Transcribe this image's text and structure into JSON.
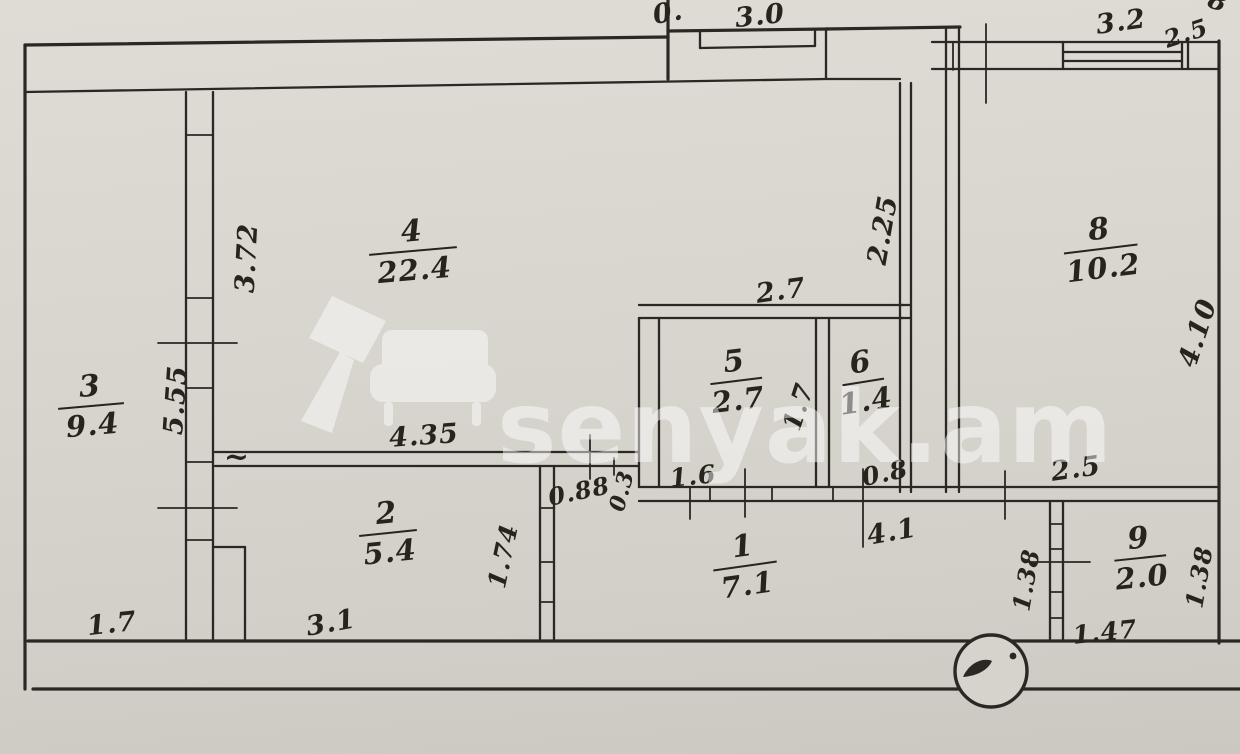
{
  "document": {
    "kind": "scanned hand-drawn apartment floor plan",
    "paper_color": "#d8d5ce",
    "ink_color": "#2b2722"
  },
  "watermark": {
    "text": "senyak.am",
    "color": "#ffffff"
  },
  "rooms": [
    {
      "number": "1",
      "area": "7.1",
      "cx": 745,
      "cy": 566,
      "bar": 64,
      "rot": -8
    },
    {
      "number": "2",
      "area": "5.4",
      "cx": 388,
      "cy": 533,
      "bar": 58,
      "rot": -6
    },
    {
      "number": "3",
      "area": "9.4",
      "cx": 91,
      "cy": 406,
      "bar": 66,
      "rot": -5
    },
    {
      "number": "4",
      "area": "22.4",
      "cx": 413,
      "cy": 251,
      "bar": 88,
      "rot": -5
    },
    {
      "number": "5",
      "area": "2.7",
      "cx": 736,
      "cy": 381,
      "bar": 52,
      "rot": -7
    },
    {
      "number": "6",
      "area": "1.4",
      "cx": 863,
      "cy": 382,
      "bar": 42,
      "rot": -9
    },
    {
      "number": "8",
      "area": "10.2",
      "cx": 1101,
      "cy": 249,
      "bar": 74,
      "rot": -7
    },
    {
      "number": "9",
      "area": "2.0",
      "cx": 1140,
      "cy": 558,
      "bar": 52,
      "rot": -6
    }
  ],
  "dimensions": [
    {
      "text": "0.",
      "x": 668,
      "y": 13,
      "rot": -10
    },
    {
      "text": "3.0",
      "x": 760,
      "y": 16,
      "rot": -6
    },
    {
      "text": "3.2",
      "x": 1121,
      "y": 22,
      "rot": -8
    },
    {
      "text": "2.5",
      "x": 1186,
      "y": 33,
      "rot": -18,
      "size": 24
    },
    {
      "text": "8",
      "x": 1218,
      "y": 2,
      "rot": 20,
      "size": 26
    },
    {
      "text": "3.72",
      "x": 247,
      "y": 258,
      "rot": -87
    },
    {
      "text": "5.55",
      "x": 176,
      "y": 400,
      "rot": -86
    },
    {
      "text": "2.25",
      "x": 883,
      "y": 230,
      "rot": -80
    },
    {
      "text": "2.7",
      "x": 781,
      "y": 291,
      "rot": -8
    },
    {
      "text": "4.10",
      "x": 1198,
      "y": 333,
      "rot": -72
    },
    {
      "text": "4.35",
      "x": 424,
      "y": 436,
      "rot": -4
    },
    {
      "text": "~",
      "x": 237,
      "y": 457,
      "rot": 0,
      "size": 30
    },
    {
      "text": "0.88",
      "x": 579,
      "y": 491,
      "rot": -12,
      "size": 24
    },
    {
      "text": "0.3",
      "x": 622,
      "y": 491,
      "rot": -75,
      "size": 22
    },
    {
      "text": "1.6",
      "x": 693,
      "y": 476,
      "rot": -6,
      "size": 25
    },
    {
      "text": "0.8",
      "x": 885,
      "y": 473,
      "rot": -12,
      "size": 25
    },
    {
      "text": "1.7",
      "x": 799,
      "y": 407,
      "rot": -72,
      "size": 26
    },
    {
      "text": "2.5",
      "x": 1076,
      "y": 469,
      "rot": -8
    },
    {
      "text": "4.1",
      "x": 892,
      "y": 532,
      "rot": -10
    },
    {
      "text": "1.74",
      "x": 503,
      "y": 556,
      "rot": -78,
      "size": 25
    },
    {
      "text": "1.38",
      "x": 1026,
      "y": 580,
      "rot": -80,
      "size": 24
    },
    {
      "text": "1.38",
      "x": 1199,
      "y": 577,
      "rot": -80,
      "size": 24
    },
    {
      "text": "1.47",
      "x": 1105,
      "y": 632,
      "rot": -6,
      "size": 25
    },
    {
      "text": "1.7",
      "x": 112,
      "y": 624,
      "rot": -6
    },
    {
      "text": "3.1",
      "x": 331,
      "y": 623,
      "rot": -10
    }
  ]
}
